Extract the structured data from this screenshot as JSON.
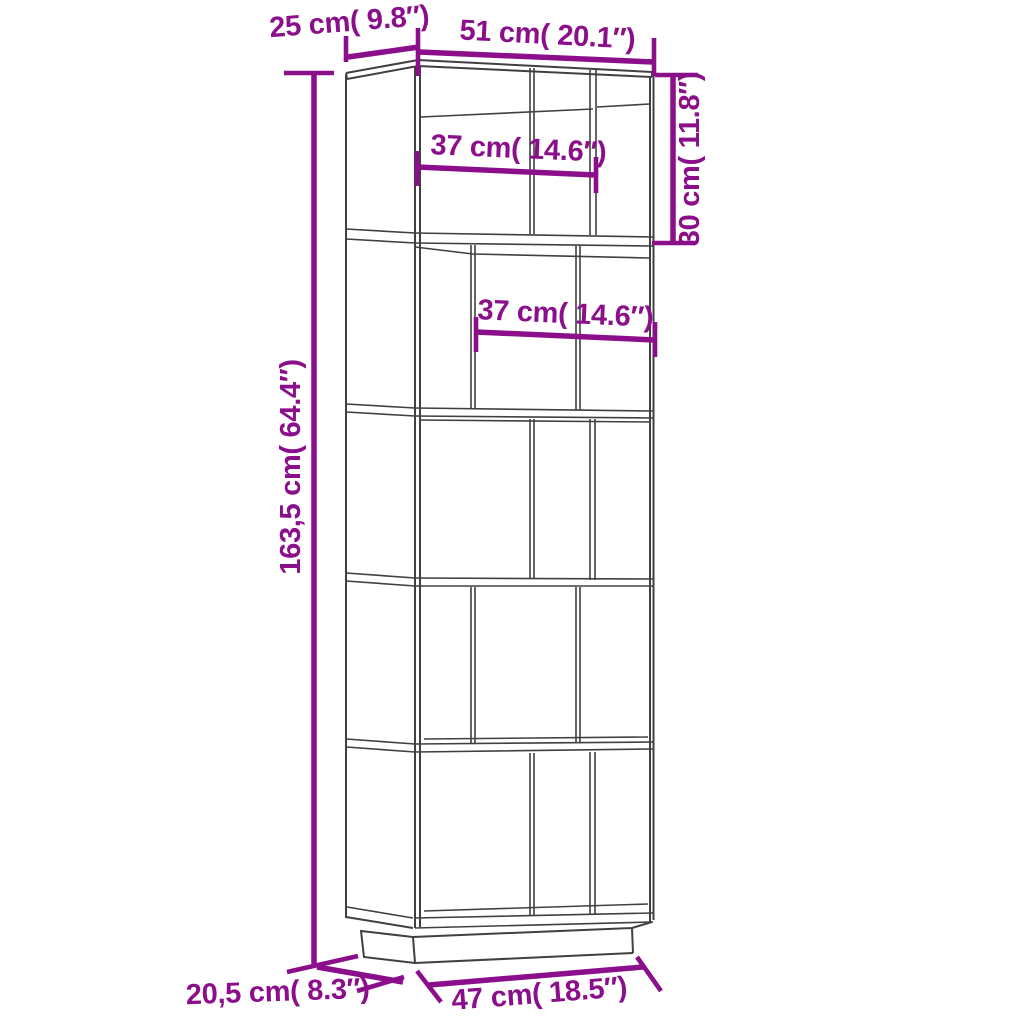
{
  "diagram": {
    "kind": "furniture-dimension-diagram",
    "subject": "5-tier book cabinet room divider line drawing",
    "accent_color": "#8b0f8b",
    "line_color": "#404040",
    "background_color": "#ffffff",
    "labels": {
      "top_depth": "25 cm( 9.8″)",
      "top_width": "51 cm( 20.1″)",
      "inner_width_tier1": "37 cm( 14.6″)",
      "inner_width_tier2": "37 cm( 14.6″)",
      "tier_height": "30 cm( 11.8″)",
      "total_height": "163,5 cm( 64.4″)",
      "base_depth": "20,5 cm( 8.3″)",
      "base_width": "47 cm( 18.5″)"
    }
  }
}
